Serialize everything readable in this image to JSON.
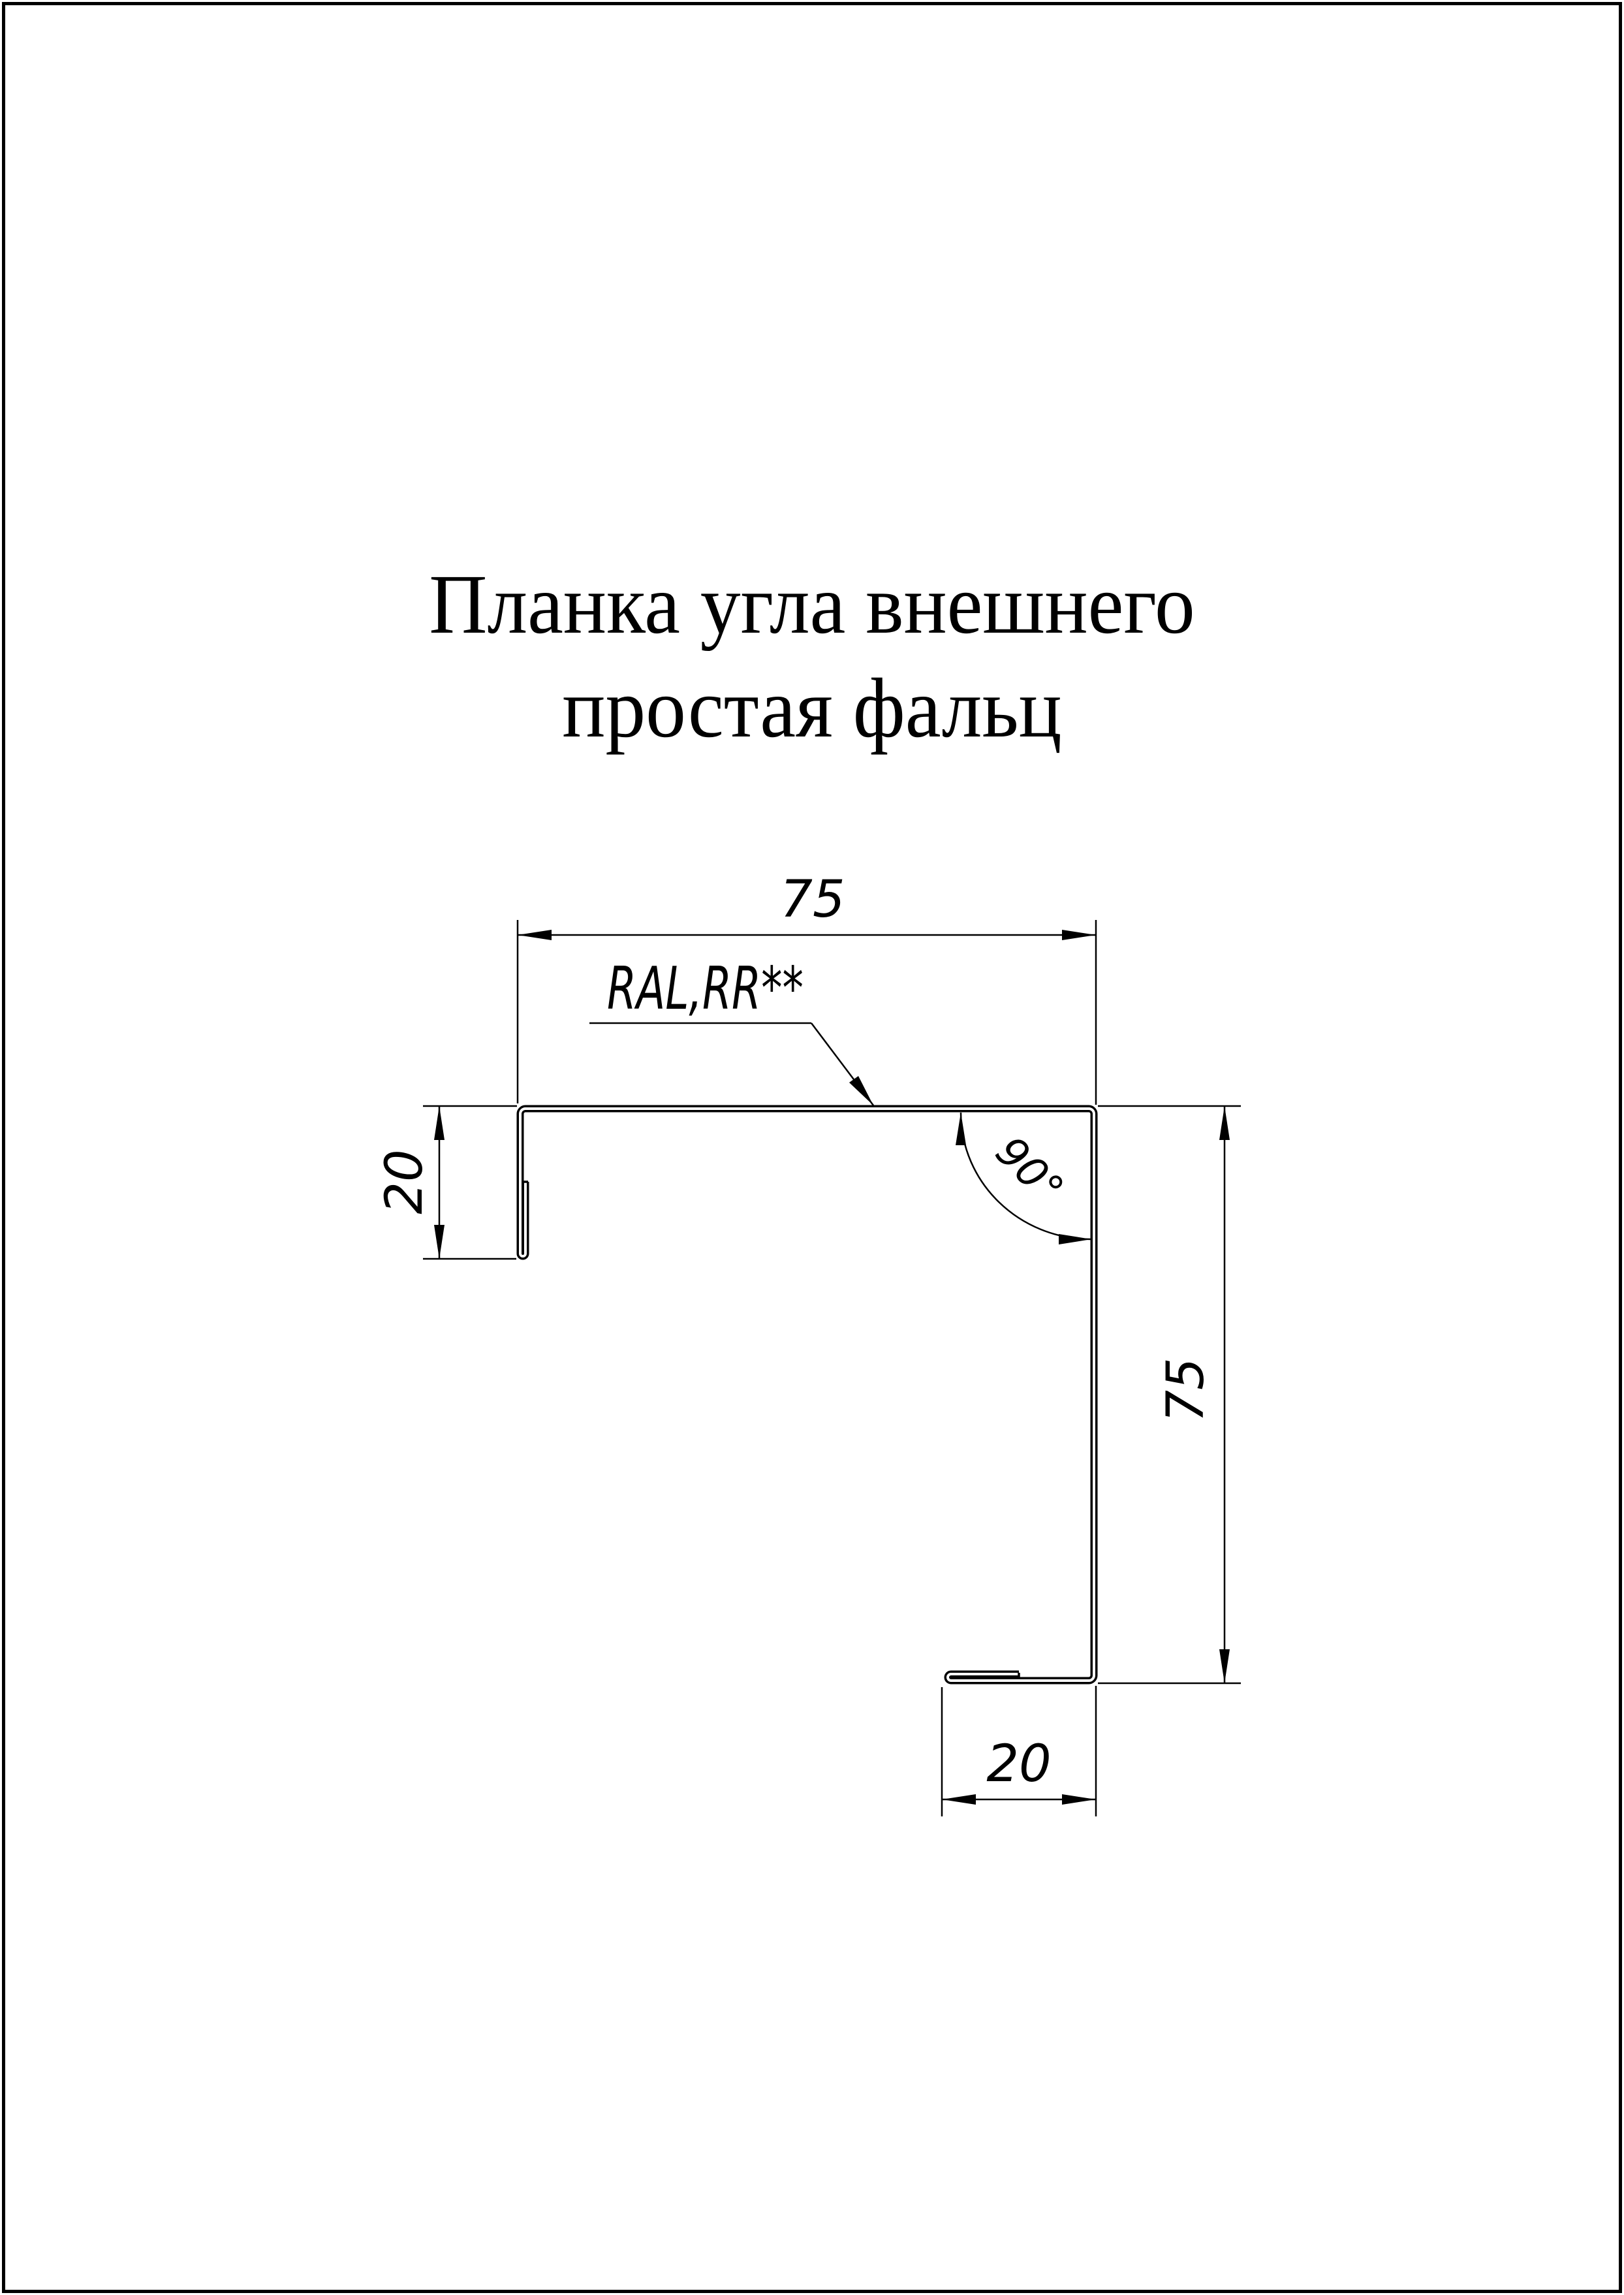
{
  "page": {
    "background": "#ffffff",
    "line_color": "#000000"
  },
  "title": {
    "line1": "Планка угла внешнего",
    "line2": "простая фальц"
  },
  "annotations": {
    "material_note": "RAL,RR**",
    "angle_label": "90°"
  },
  "dimensions": {
    "top_width": "75",
    "left_hem": "20",
    "right_height": "75",
    "bottom_hem": "20"
  }
}
